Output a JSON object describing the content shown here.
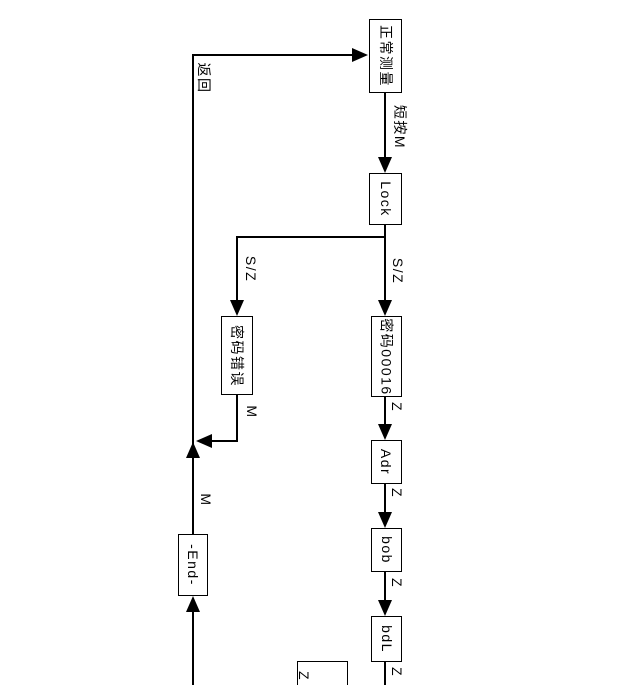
{
  "diagram": {
    "type": "flowchart",
    "orientation": "rotated-90-clockwise",
    "colors": {
      "background": "#ffffff",
      "line": "#000000",
      "box_fill": "#ffffff",
      "text": "#000000"
    },
    "nodes": {
      "normal_measure": "正常测量",
      "lock": "Lock",
      "password_error": "密码错误",
      "password_value": "密码00016",
      "adr": "Adr",
      "bob": "bob",
      "bdl": "bdL",
      "end": "-End-",
      "partial_bottom": "Z"
    },
    "labels": {
      "return": "返回",
      "short_press_m": "短按M",
      "sz": "S/Z",
      "m": "M",
      "z": "Z"
    },
    "flow": "正常测量 -短按M-> Lock -S/Z-> 密码00016 -Z-> Adr -Z-> bob -Z-> bdL ; Lock -S/Z-> 密码错误 -M-> 返回 ; -End- -M-> 返回 -> 正常测量"
  }
}
